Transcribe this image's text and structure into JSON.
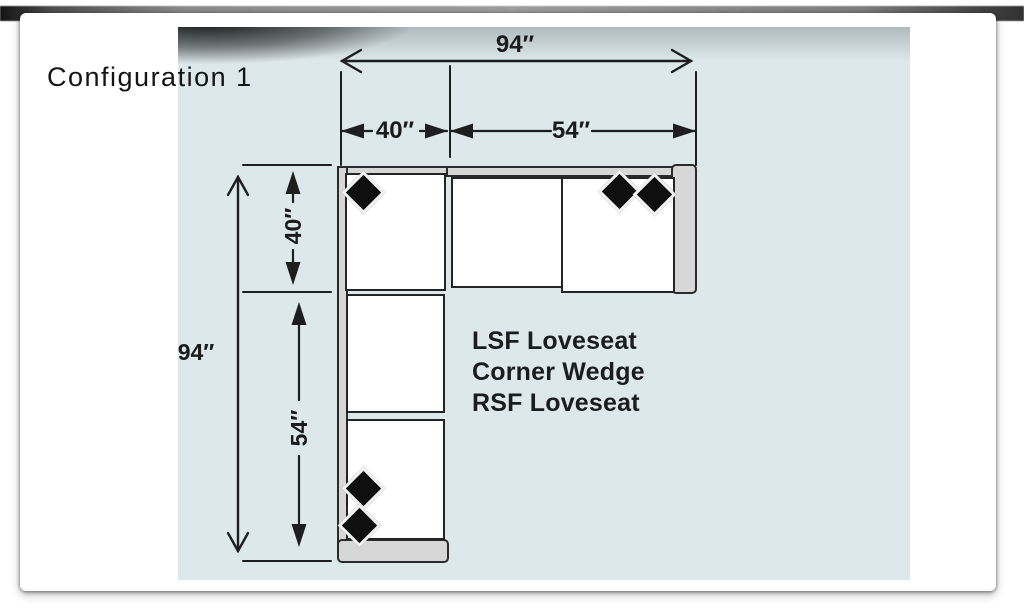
{
  "window": {
    "title": "Configuration 1"
  },
  "diagram": {
    "dimensions": {
      "total_width": "94″",
      "width_segment_corner": "40″",
      "width_segment_loveseat": "54″",
      "total_depth": "94″",
      "depth_segment_corner": "40″",
      "depth_segment_loveseat": "54″"
    },
    "components": [
      "LSF Loveseat",
      "Corner Wedge",
      "RSF Loveseat"
    ],
    "colors": {
      "canvas": "#dde8eb",
      "line": "#1e1e1e",
      "cushion": "#ffffff",
      "frame": "#d7d7d7",
      "pillow": "#0f0f0f"
    }
  }
}
